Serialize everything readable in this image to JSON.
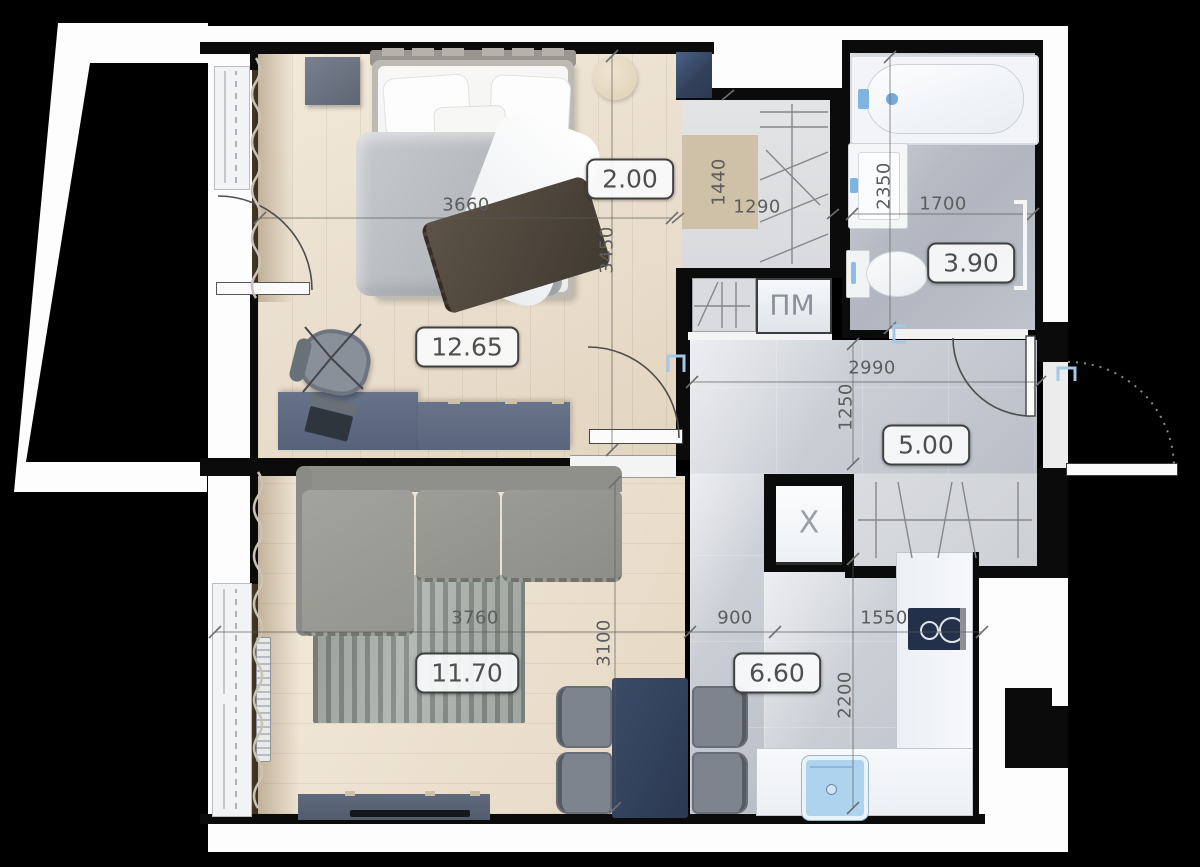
{
  "plan": {
    "type": "apartment-floor-plan",
    "areas": {
      "bedroom": "12.65",
      "nook": "2.00",
      "bathroom": "3.90",
      "hallway": "5.00",
      "living": "11.70",
      "kitchen": "6.60"
    },
    "dims": {
      "bedroom_w": "3660",
      "bedroom_h": "3450",
      "nook_h": "1440",
      "nook_w": "1290",
      "bath_h": "2350",
      "bath_w": "1700",
      "hall_w": "2990",
      "hall_h": "1250",
      "living_w": "3760",
      "living_h": "3100",
      "kitchen_a": "900",
      "kitchen_b": "1550",
      "kitchen_h": "2200"
    },
    "labels": {
      "washer": "ПМ",
      "utility": "X"
    },
    "colors": {
      "background": "#000000",
      "walls": "#0b0b0b",
      "poche": "#fdfdfd",
      "wood_floor": "#eadfcd",
      "tile_floor": "#c9cdd4",
      "bath_floor": "#b7bbc3",
      "table_navy": "#32415c",
      "cooktop_navy": "#22304a",
      "sink_blue": "#aed3ee",
      "fixture_blue": "#7fb3e0",
      "sofa_gray": "#97978f",
      "rug_gray": "#9aa09c"
    }
  }
}
